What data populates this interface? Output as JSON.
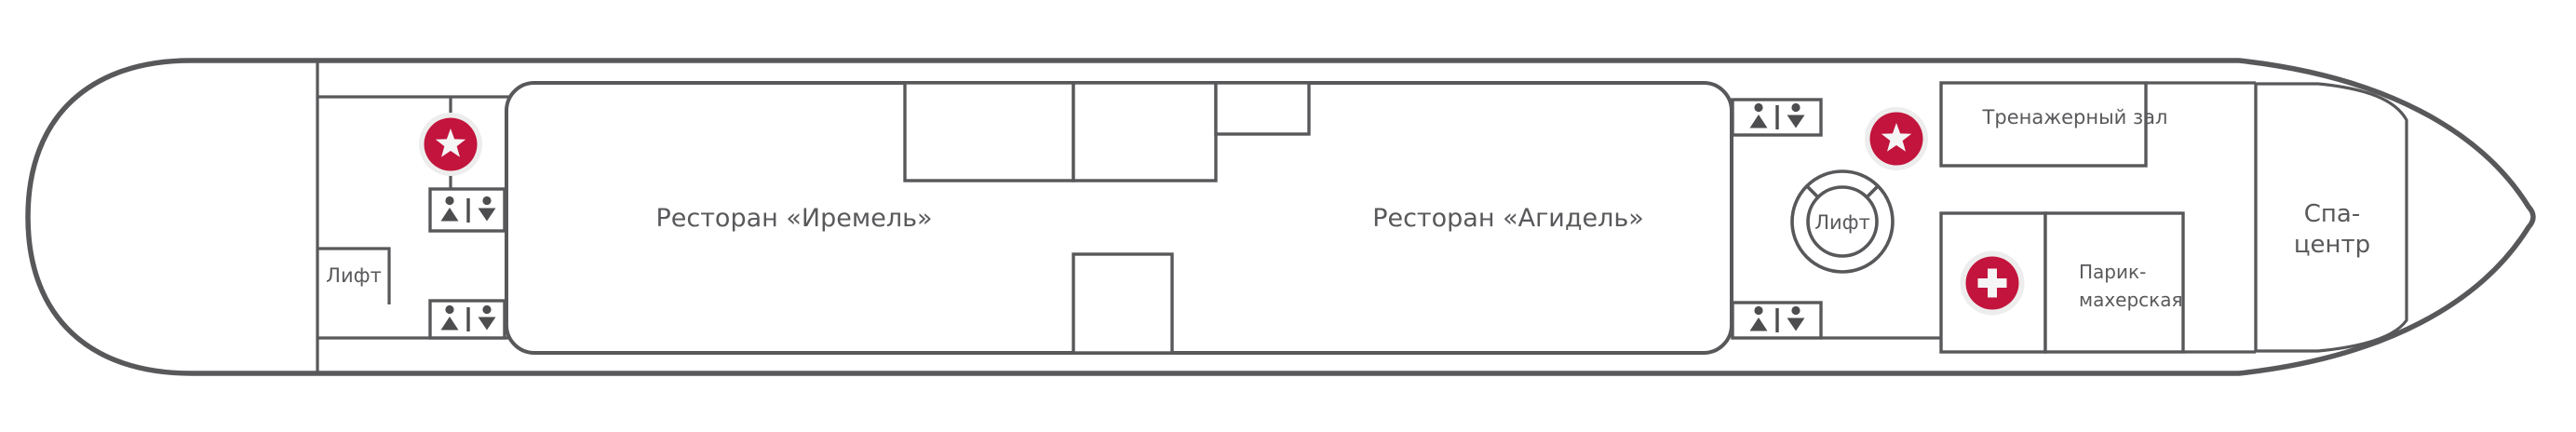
{
  "deck_plan": {
    "labels": {
      "restaurant_iremel": "Ресторан «Иремель»",
      "restaurant_agidel": "Ресторан «Агидель»",
      "elevator_left": "Лифт",
      "elevator_right": "Лифт",
      "gym": "Тренажерный зал",
      "hairdresser_line1": "Парик-",
      "hairdresser_line2": "махерская",
      "spa_line1": "Спа-",
      "spa_line2": "центр"
    },
    "colors": {
      "accent_red": "#c2143c",
      "wall_gray": "#58585b",
      "icon_gray": "#4d4d4f",
      "marker_halo": "#ededed",
      "marker_glyph": "#f5f5f5"
    },
    "icons": [
      "star-marker-left",
      "star-marker-right",
      "medical-cross-marker",
      "elevator-ring-icon",
      "wc-men-women-icon-x4"
    ]
  }
}
